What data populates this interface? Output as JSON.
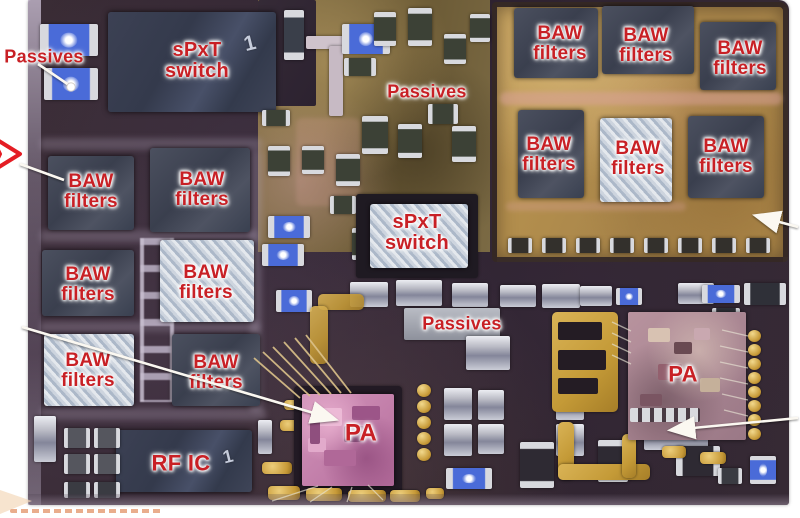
{
  "figure": {
    "description": "Annotated photograph of an RF front-end module board with labeled dies and components",
    "colors": {
      "label_red": "#c82025",
      "annotation_white": "#ffffff",
      "chevron_red": "#e41d24",
      "module_gold": "#bd9750",
      "substrate_dark": "#362833",
      "baw_chip_dark": "#444959",
      "baw_chip_light": "#bcc6d3",
      "pa_die_pink": "#d294ba"
    }
  },
  "labels": {
    "passives_top_left": "Passives",
    "passives_top_middle": "Passives",
    "passives_center": "Passives",
    "spxt_switch_top_left": "sPxT\nswitch",
    "spxt_switch_center": "sPxT\nswitch",
    "baw_filters": [
      "BAW\nfilters",
      "BAW\nfilters",
      "BAW\nfilters",
      "BAW\nfilters",
      "BAW\nfilters",
      "BAW\nfilters",
      "BAW\nfilters",
      "BAW\nfilters",
      "BAW\nfilters",
      "BAW\nfilters",
      "BAW\nfilters",
      "BAW\nfilters"
    ],
    "pa_center": "PA",
    "pa_right": "PA",
    "rf_ic": "RF IC",
    "spxt_die_marking": "1",
    "rf_ic_die_marking": "1"
  }
}
